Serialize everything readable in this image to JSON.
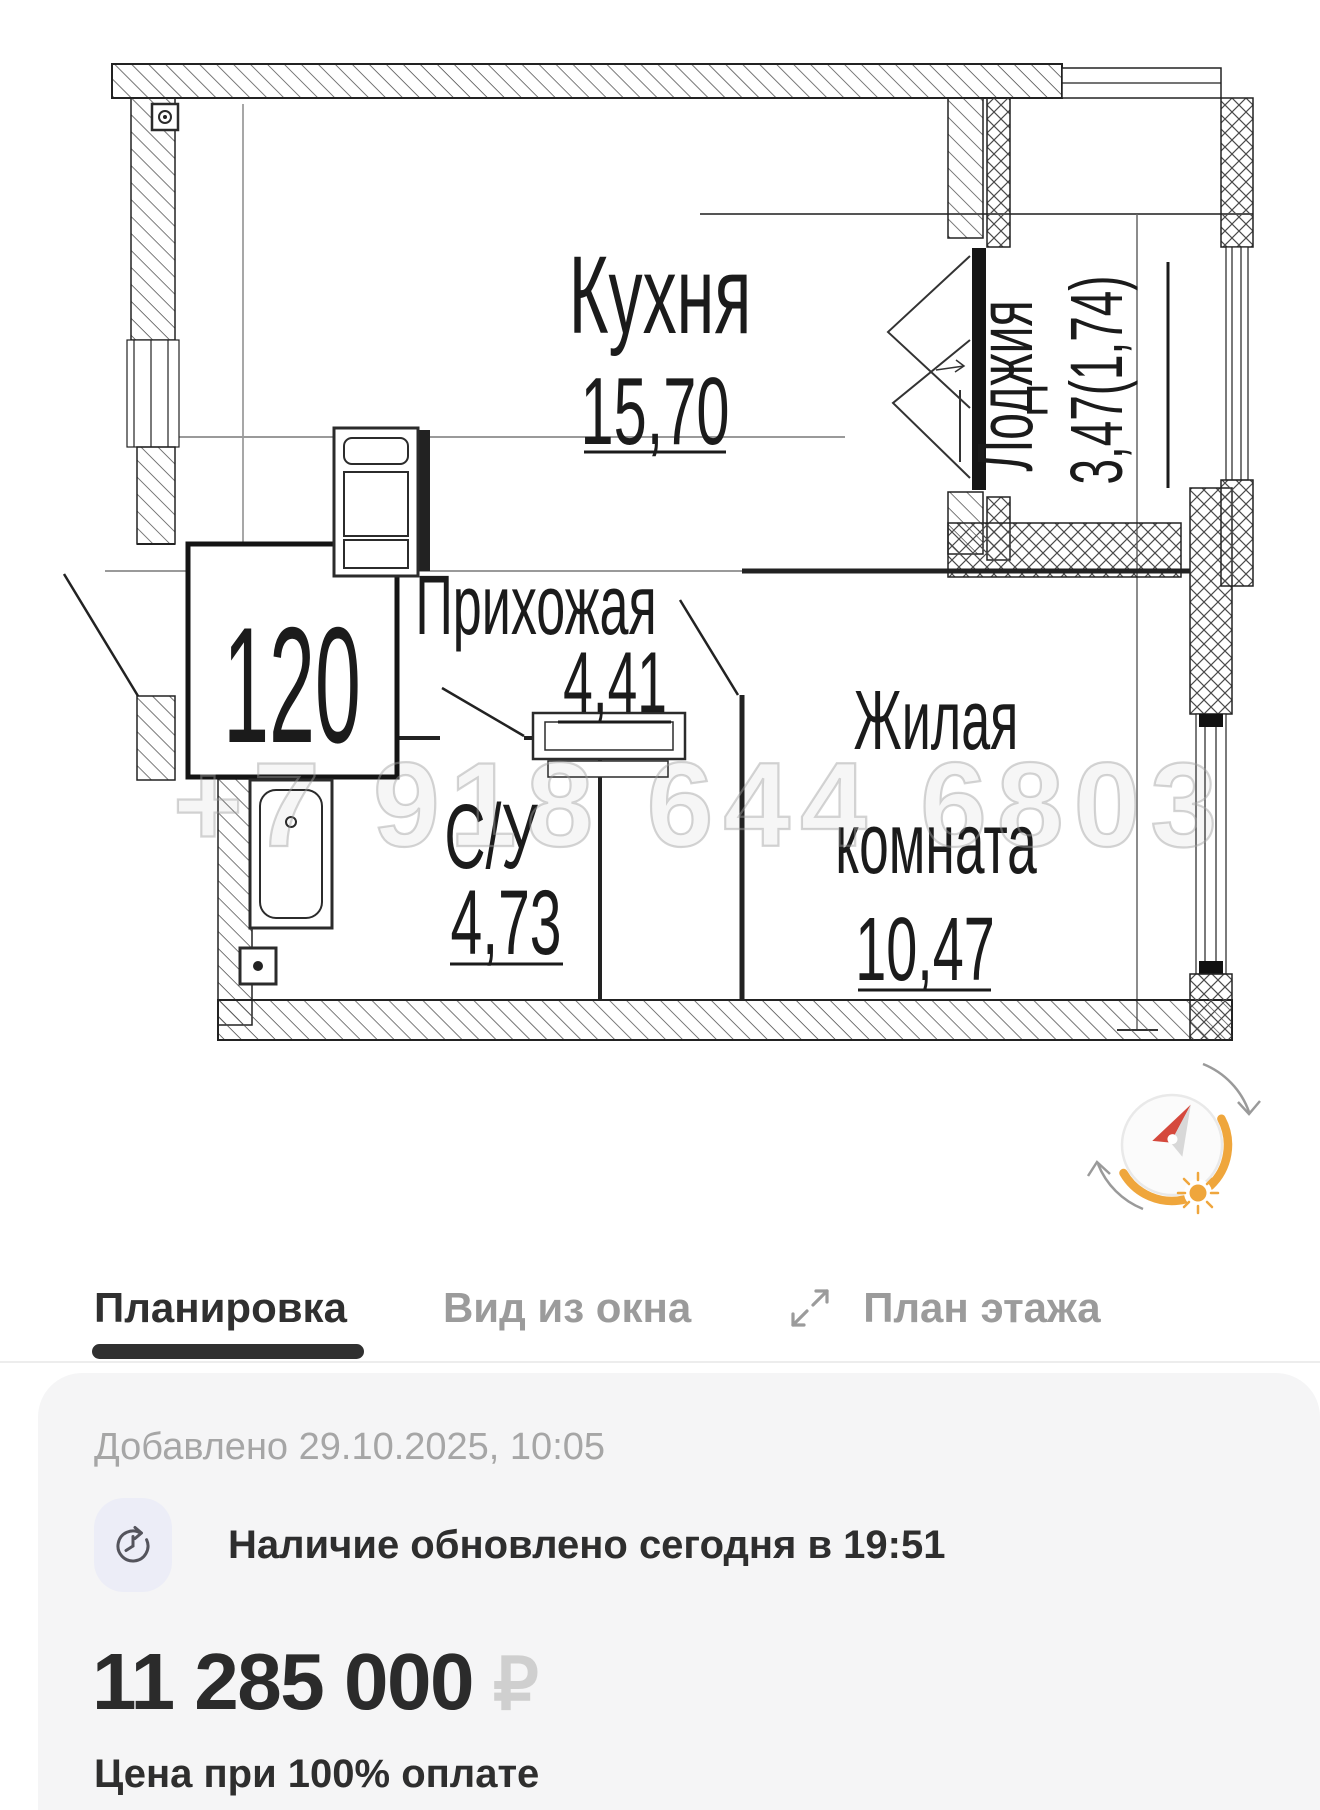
{
  "floorplan": {
    "unit_number": "120",
    "watermark": "+7 918 644 6803",
    "rooms": {
      "kitchen": {
        "label": "Кухня",
        "area": "15,70"
      },
      "loggia": {
        "label": "Лоджия",
        "area": "3,47(1,74)"
      },
      "hallway": {
        "label": "Прихожая",
        "area": "4,41"
      },
      "bathroom": {
        "label": "С/У",
        "area": "4,73"
      },
      "living": {
        "label_line1": "Жилая",
        "label_line2": "комната",
        "area": "10,47"
      }
    }
  },
  "tabs": [
    {
      "label": "Планировка",
      "active": true
    },
    {
      "label": "Вид из окна",
      "active": false
    },
    {
      "label": "План этажа",
      "active": false,
      "icon": "expand-icon"
    }
  ],
  "card": {
    "added": "Добавлено 29.10.2025, 10:05",
    "availability": "Наличие обновлено сегодня в 19:51",
    "price": "11 285 000",
    "currency": "₽",
    "price_note": "Цена при 100% оплате"
  },
  "colors": {
    "accent_orange": "#EFA63C",
    "needle_red": "#D5493D",
    "tab_active": "#303030",
    "tab_inactive": "#9B9B9B",
    "card_background": "#F5F5F6",
    "muted_text": "#A6A6A6",
    "currency_gray": "#CFCFCF"
  }
}
